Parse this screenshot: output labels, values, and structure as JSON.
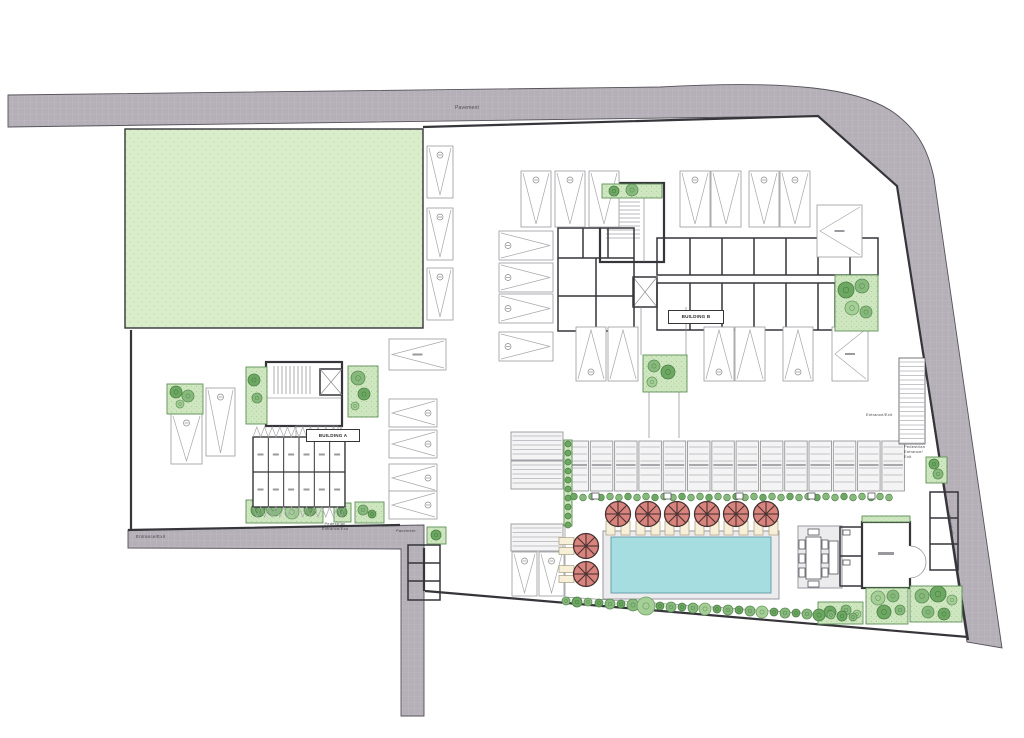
{
  "labels": {
    "pavement_top": "Pavement",
    "building_a": "BUILDING A",
    "building_b": "BUILDING B",
    "entrance_exit_left": "Entrance/Exit",
    "pedestrian_center": "Pedestrian\nEntrance/Exit",
    "pavement_center": "Pavement",
    "entrance_exit_right": "Entrance/Exit",
    "pedestrian_right": "Pedestrian\nEntrance/\nExit",
    "pavement_right": "Pavement"
  },
  "palette": {
    "road": "#b5afb8",
    "roadLine": "#c6c1c9",
    "roadEdge": "#56525a",
    "wall": "#35353a",
    "lawn": "#d9edca",
    "lawnDot": "#c0dcae",
    "planter": "#cfe7c0",
    "planterEdge": "#5d8f57",
    "bayEdge": "#9a9a9e",
    "pool": "#a6dde1",
    "poolEdge": "#5f9ba3",
    "deck": "#ececee",
    "umbrella": "#d9837d",
    "umbrellaDark": "#4a3333",
    "lounger": "#f7efd8",
    "slat": "#b2b2b6",
    "text": "#4a4a4e"
  },
  "features": {
    "bays": [
      {
        "x": 427,
        "y": 146,
        "w": 26,
        "h": 52,
        "dir": "d",
        "c": 1
      },
      {
        "x": 427,
        "y": 208,
        "w": 26,
        "h": 52,
        "dir": "d",
        "c": 1
      },
      {
        "x": 427,
        "y": 268,
        "w": 26,
        "h": 52,
        "dir": "d",
        "c": 1
      },
      {
        "x": 521,
        "y": 171,
        "w": 30,
        "h": 56,
        "dir": "d",
        "c": 1
      },
      {
        "x": 555,
        "y": 171,
        "w": 30,
        "h": 56,
        "dir": "d",
        "c": 1
      },
      {
        "x": 589,
        "y": 171,
        "w": 30,
        "h": 56,
        "dir": "d",
        "c": 0
      },
      {
        "x": 680,
        "y": 171,
        "w": 30,
        "h": 56,
        "dir": "d",
        "c": 1
      },
      {
        "x": 711,
        "y": 171,
        "w": 30,
        "h": 56,
        "dir": "d",
        "c": 0
      },
      {
        "x": 749,
        "y": 171,
        "w": 30,
        "h": 56,
        "dir": "d",
        "c": 1
      },
      {
        "x": 780,
        "y": 171,
        "w": 30,
        "h": 56,
        "dir": "d",
        "c": 1
      },
      {
        "x": 499,
        "y": 231,
        "w": 54,
        "h": 29,
        "dir": "r",
        "c": 1
      },
      {
        "x": 499,
        "y": 263,
        "w": 54,
        "h": 29,
        "dir": "r",
        "c": 1
      },
      {
        "x": 499,
        "y": 294,
        "w": 54,
        "h": 29,
        "dir": "r",
        "c": 1
      },
      {
        "x": 499,
        "y": 332,
        "w": 54,
        "h": 29,
        "dir": "r",
        "c": 1
      },
      {
        "x": 576,
        "y": 327,
        "w": 30,
        "h": 54,
        "dir": "u",
        "c": 1
      },
      {
        "x": 608,
        "y": 327,
        "w": 30,
        "h": 54,
        "dir": "u",
        "c": 0
      },
      {
        "x": 704,
        "y": 327,
        "w": 30,
        "h": 54,
        "dir": "u",
        "c": 1
      },
      {
        "x": 735,
        "y": 327,
        "w": 30,
        "h": 54,
        "dir": "u",
        "c": 0
      },
      {
        "x": 783,
        "y": 327,
        "w": 30,
        "h": 54,
        "dir": "u",
        "c": 1
      },
      {
        "x": 389,
        "y": 399,
        "w": 48,
        "h": 28,
        "dir": "l",
        "c": 1
      },
      {
        "x": 389,
        "y": 430,
        "w": 48,
        "h": 28,
        "dir": "l",
        "c": 1
      },
      {
        "x": 389,
        "y": 464,
        "w": 48,
        "h": 28,
        "dir": "l",
        "c": 1
      },
      {
        "x": 389,
        "y": 491,
        "w": 48,
        "h": 28,
        "dir": "l",
        "c": 1
      },
      {
        "x": 171,
        "y": 414,
        "w": 31,
        "h": 50,
        "dir": "d",
        "c": 1
      },
      {
        "x": 206,
        "y": 388,
        "w": 29,
        "h": 68,
        "dir": "d",
        "c": 1
      },
      {
        "x": 512,
        "y": 552,
        "w": 25,
        "h": 44,
        "dir": "d",
        "c": 1
      },
      {
        "x": 539,
        "y": 552,
        "w": 25,
        "h": 44,
        "dir": "d",
        "c": 1
      }
    ],
    "xbays": [
      {
        "x": 817,
        "y": 205,
        "w": 45,
        "h": 52,
        "dir": "l"
      },
      {
        "x": 832,
        "y": 327,
        "w": 36,
        "h": 54,
        "dir": "l"
      },
      {
        "x": 389,
        "y": 339,
        "w": 57,
        "h": 31,
        "dir": "l"
      }
    ],
    "slatBoxes": [
      {
        "x": 511,
        "y": 432,
        "w": 52,
        "h": 28
      },
      {
        "x": 511,
        "y": 461,
        "w": 52,
        "h": 28
      },
      {
        "x": 511,
        "y": 524,
        "w": 52,
        "h": 27
      }
    ],
    "pergolas": {
      "x": 566,
      "y": 441,
      "w": 22.5,
      "h": 50,
      "count": 14,
      "step": 24.3
    },
    "umbrellas": [
      {
        "cx": 618,
        "cy": 514,
        "pads": "b"
      },
      {
        "cx": 648,
        "cy": 514,
        "pads": "b"
      },
      {
        "cx": 677,
        "cy": 514,
        "pads": "b"
      },
      {
        "cx": 707,
        "cy": 514,
        "pads": "b"
      },
      {
        "cx": 736,
        "cy": 514,
        "pads": "b"
      },
      {
        "cx": 766,
        "cy": 514,
        "pads": "b"
      },
      {
        "cx": 586,
        "cy": 546,
        "pads": "l"
      },
      {
        "cx": 586,
        "cy": 574,
        "pads": "l"
      }
    ],
    "planters": [
      {
        "x": 602,
        "y": 184,
        "w": 60,
        "h": 14,
        "trees": [
          [
            614,
            191,
            5,
            "b"
          ],
          [
            632,
            190,
            6,
            "a"
          ]
        ]
      },
      {
        "x": 835,
        "y": 275,
        "w": 43,
        "h": 56,
        "trees": [
          [
            846,
            290,
            8,
            "b"
          ],
          [
            862,
            286,
            7,
            "a"
          ],
          [
            852,
            308,
            7,
            "c"
          ],
          [
            866,
            312,
            6,
            "a"
          ]
        ]
      },
      {
        "x": 643,
        "y": 355,
        "w": 44,
        "h": 37,
        "trees": [
          [
            654,
            366,
            6,
            "a"
          ],
          [
            668,
            372,
            7,
            "b"
          ],
          [
            652,
            382,
            5,
            "c"
          ]
        ]
      },
      {
        "x": 246,
        "y": 367,
        "w": 21,
        "h": 57,
        "trees": [
          [
            254,
            380,
            6,
            "b"
          ],
          [
            257,
            398,
            5,
            "a"
          ]
        ]
      },
      {
        "x": 348,
        "y": 366,
        "w": 30,
        "h": 51,
        "trees": [
          [
            358,
            378,
            7,
            "a"
          ],
          [
            364,
            394,
            6,
            "b"
          ],
          [
            355,
            406,
            4,
            "c"
          ]
        ]
      },
      {
        "x": 246,
        "y": 500,
        "w": 77,
        "h": 23,
        "trees": [
          [
            258,
            510,
            7,
            "b"
          ],
          [
            274,
            508,
            8,
            "a"
          ],
          [
            292,
            512,
            7,
            "c"
          ],
          [
            310,
            510,
            6,
            "b"
          ]
        ]
      },
      {
        "x": 334,
        "y": 503,
        "w": 17,
        "h": 19,
        "trees": [
          [
            342,
            512,
            5,
            "b"
          ]
        ]
      },
      {
        "x": 355,
        "y": 502,
        "w": 29,
        "h": 21,
        "trees": [
          [
            363,
            510,
            5,
            "a"
          ],
          [
            372,
            514,
            4,
            "b"
          ]
        ]
      },
      {
        "x": 167,
        "y": 384,
        "w": 36,
        "h": 30,
        "trees": [
          [
            176,
            392,
            6,
            "b"
          ],
          [
            188,
            396,
            6,
            "a"
          ],
          [
            180,
            404,
            4,
            "c"
          ]
        ]
      },
      {
        "x": 427,
        "y": 527,
        "w": 19,
        "h": 17,
        "trees": [
          [
            436,
            535,
            5,
            "b"
          ]
        ]
      },
      {
        "x": 926,
        "y": 457,
        "w": 21,
        "h": 26,
        "trees": [
          [
            934,
            464,
            5,
            "b"
          ],
          [
            938,
            474,
            5,
            "a"
          ]
        ]
      },
      {
        "x": 862,
        "y": 516,
        "w": 48,
        "h": 6,
        "trees": []
      }
    ],
    "gardens": [
      {
        "x": 818,
        "y": 602,
        "w": 45,
        "h": 22,
        "trees": [
          [
            830,
            612,
            6,
            "b"
          ],
          [
            846,
            610,
            5,
            "a"
          ],
          [
            857,
            614,
            4,
            "c"
          ]
        ]
      },
      {
        "x": 866,
        "y": 588,
        "w": 42,
        "h": 36,
        "trees": [
          [
            878,
            598,
            7,
            "c"
          ],
          [
            893,
            596,
            6,
            "a"
          ],
          [
            884,
            612,
            7,
            "b"
          ],
          [
            900,
            610,
            5,
            "a"
          ]
        ]
      },
      {
        "x": 910,
        "y": 586,
        "w": 52,
        "h": 36,
        "trees": [
          [
            922,
            596,
            7,
            "a"
          ],
          [
            938,
            594,
            8,
            "b"
          ],
          [
            952,
            600,
            5,
            "c"
          ],
          [
            928,
            612,
            6,
            "a"
          ],
          [
            944,
            614,
            6,
            "b"
          ]
        ]
      }
    ],
    "treeRow": [
      [
        566,
        601,
        4,
        "a"
      ],
      [
        577,
        602,
        5,
        "b"
      ],
      [
        588,
        602,
        4,
        "a"
      ],
      [
        599,
        603,
        4,
        "b"
      ],
      [
        610,
        604,
        5,
        "a"
      ],
      [
        621,
        604,
        4,
        "b"
      ],
      [
        633,
        605,
        6,
        "a"
      ],
      [
        646,
        606,
        9,
        "c"
      ],
      [
        660,
        606,
        4,
        "b"
      ],
      [
        671,
        607,
        5,
        "a"
      ],
      [
        682,
        607,
        4,
        "b"
      ],
      [
        693,
        608,
        5,
        "a"
      ],
      [
        705,
        609,
        6,
        "c"
      ],
      [
        717,
        609,
        4,
        "b"
      ],
      [
        728,
        610,
        5,
        "a"
      ],
      [
        739,
        610,
        4,
        "b"
      ],
      [
        750,
        611,
        5,
        "a"
      ],
      [
        762,
        612,
        6,
        "c"
      ],
      [
        774,
        612,
        4,
        "b"
      ],
      [
        785,
        613,
        5,
        "a"
      ],
      [
        796,
        613,
        4,
        "b"
      ],
      [
        807,
        614,
        5,
        "a"
      ],
      [
        819,
        615,
        6,
        "b"
      ],
      [
        831,
        615,
        4,
        "a"
      ],
      [
        842,
        616,
        5,
        "b"
      ],
      [
        853,
        617,
        4,
        "a"
      ]
    ],
    "shrubRow": {
      "x0": 574,
      "x1": 890,
      "y": 496.5,
      "step": 9,
      "r": 3.4,
      "boxes": [
        592,
        664,
        736,
        808,
        868
      ]
    },
    "hedge": {
      "x": 564,
      "y": 440,
      "w": 8,
      "h": 86
    },
    "ramp": {
      "x": 899,
      "y": 358,
      "w": 26,
      "h": 86
    },
    "storage": {
      "x": 253,
      "y": 437,
      "cols": 6,
      "colW": 15.33,
      "rowH": 35
    }
  }
}
